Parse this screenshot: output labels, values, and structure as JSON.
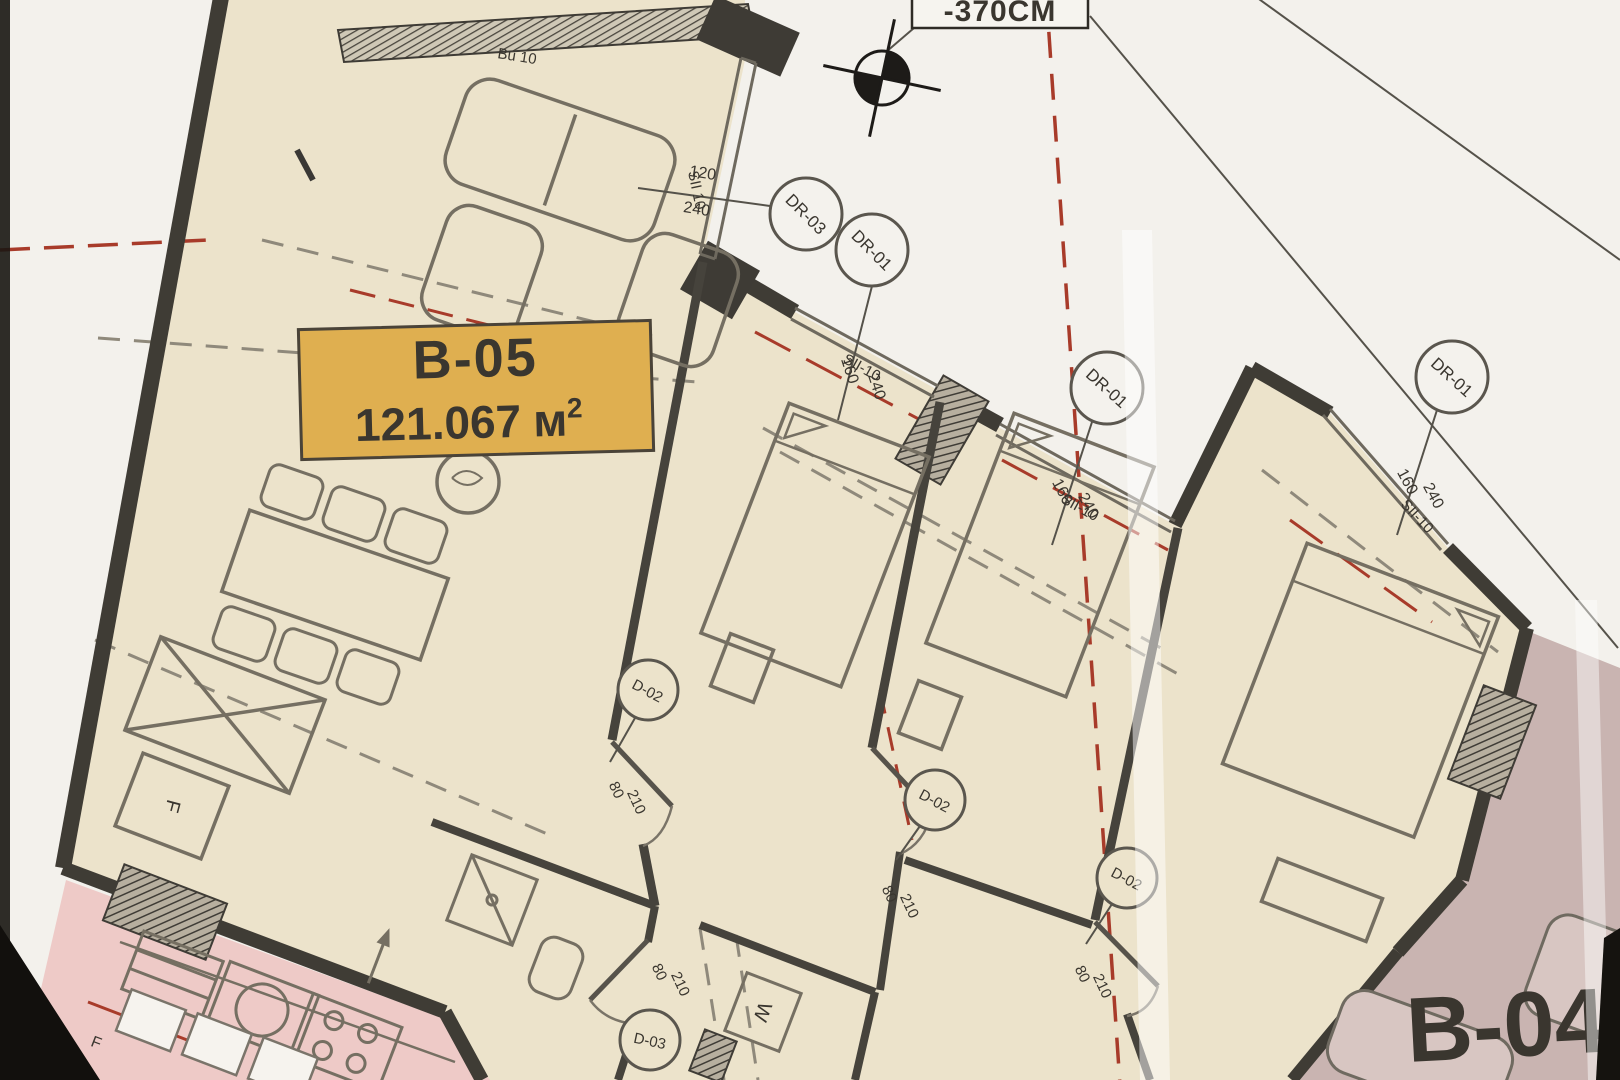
{
  "plan": {
    "unit": {
      "code": "B-05",
      "area_value": "121.067",
      "area_unit": "м",
      "area_sup": "2"
    },
    "level_note": "-370CM",
    "exterior_doors": [
      {
        "id": "DR-03",
        "dim_w": "120",
        "dim_h": "240"
      },
      {
        "id": "DR-01",
        "dim_w": "160",
        "dim_h": "240"
      },
      {
        "id": "DR-01",
        "dim_w": "160",
        "dim_h": "240"
      },
      {
        "id": "DR-01",
        "dim_w": "160",
        "dim_h": "240"
      }
    ],
    "interior_doors": [
      {
        "id": "D-02",
        "dim_w": "80",
        "dim_h": "210"
      },
      {
        "id": "D-02",
        "dim_w": "80",
        "dim_h": "210"
      },
      {
        "id": "D-02",
        "dim_w": "80",
        "dim_h": "210"
      },
      {
        "id": "D-03",
        "dim_w": "80",
        "dim_h": "210"
      }
    ],
    "windows": [
      {
        "id": "Bu 10"
      },
      {
        "id": "SII 10"
      },
      {
        "id": "SII-10"
      },
      {
        "id": "SII-10"
      },
      {
        "id": "SII-10"
      }
    ],
    "appliances": {
      "fridge": "F",
      "washer": "W"
    },
    "neighbor": {
      "code": "B-04",
      "fridge": "F"
    },
    "colors": {
      "paper": "#f3f1ec",
      "unit_fill": "#ece3cb",
      "label_fill": "#dfaf50",
      "neighbor_fill": "#c9b4b1",
      "neighbor2_fill": "#eecac7",
      "wall": "#3f3c35",
      "red_axis": "#a83b2a"
    }
  }
}
